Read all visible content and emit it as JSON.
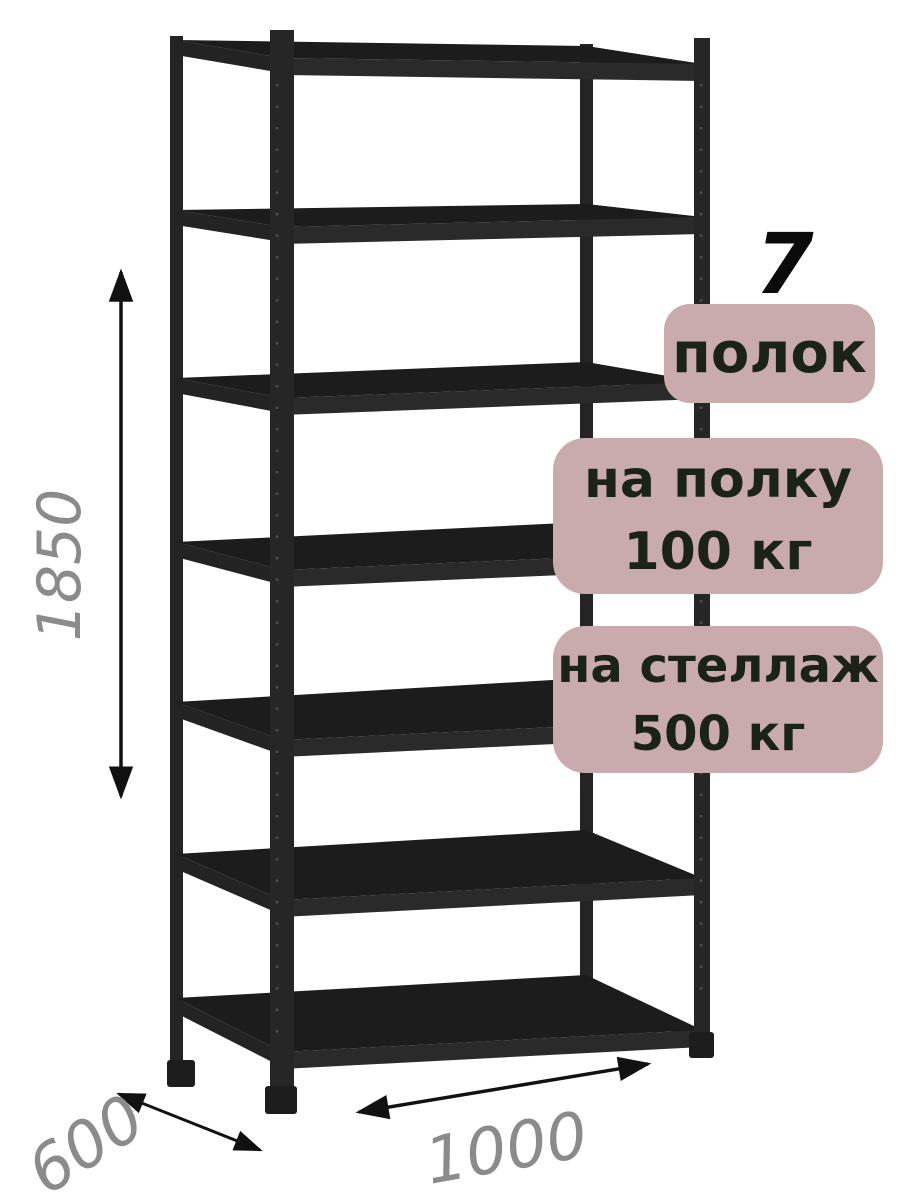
{
  "annotations": {
    "shelf_count_number": "7",
    "shelf_count_label": "полок",
    "per_shelf_load": {
      "line1": "на полку",
      "line2": "100 кг"
    },
    "per_rack_load": {
      "line1": "на стеллаж",
      "line2": "500 кг"
    },
    "badge_bg_color": "#c9abad",
    "badge_text_color": "#1b2316"
  },
  "dimensions": {
    "height": "1850",
    "depth": "600",
    "width": "1000",
    "label_color": "#8b8b8b",
    "arrow_color": "#111111"
  },
  "illustration": {
    "subject": "black metal boltless shelving rack, 7 shelves",
    "frame_color": "#232323",
    "background": "#ffffff"
  }
}
